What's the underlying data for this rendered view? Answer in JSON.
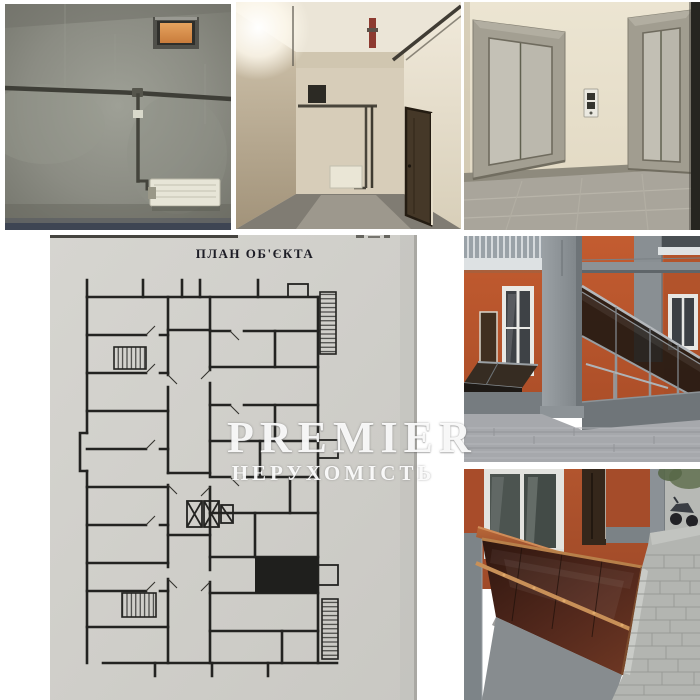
{
  "gallery": {
    "background": "#ffffff"
  },
  "plan": {
    "title": "ПЛАН ОБ'ЄКТА",
    "watermark": {
      "brand": "PREMIER",
      "tagline": "НЕРУХОМІСТЬ"
    },
    "colors": {
      "paper": "#d1d0cb",
      "ink": "#232321",
      "highlight_room": "#1f1f1d"
    }
  },
  "photo_colors": {
    "basement_wall": "#8e8e85",
    "basement_window_glow": "#d9944f",
    "corridor_wall": "#d6cab4",
    "corridor_floor": "#87837a",
    "corridor_door": "#463a2b",
    "lobby_wall": "#e8e1cd",
    "elevator_frame": "#a19d90",
    "elevator_door": "#b9b6ab",
    "facade_orange": "#bf5a2f",
    "concrete_grey": "#8d9397",
    "canopy_glass": "#4e261c",
    "canopy_rail_copper": "#c48a52",
    "paving_grey": "#abadaf"
  }
}
